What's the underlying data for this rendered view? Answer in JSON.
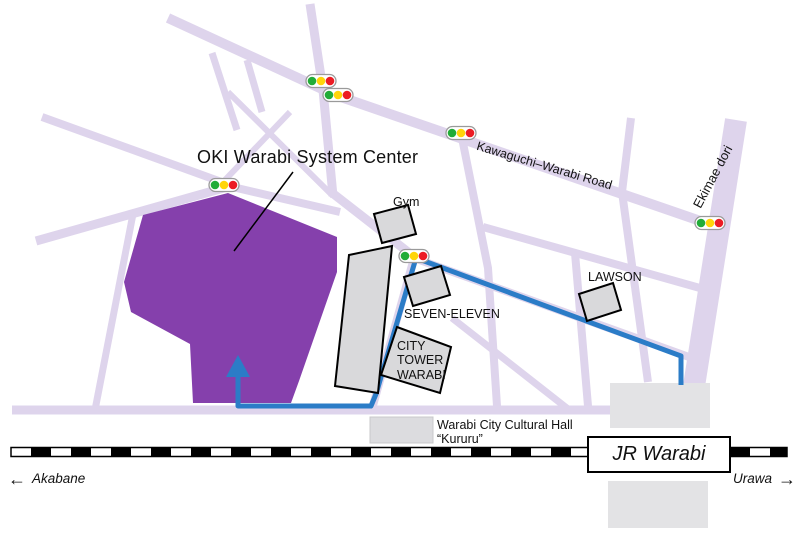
{
  "map": {
    "title": "OKI Warabi System Center",
    "roads": {
      "kawaguchi_label": "Kawaguchi–Warabi Road",
      "ekimae_label": "Ekimae dori"
    },
    "places": {
      "gym": "Gym",
      "seven_eleven": "SEVEN-ELEVEN",
      "lawson": "LAWSON",
      "city_tower_line1": "CITY",
      "city_tower_line2": "TOWER",
      "city_tower_line3": "WARABI",
      "cultural_hall_line1": "Warabi City Cultural Hall",
      "cultural_hall_line2": "“Kururu”",
      "station": "JR Warabi"
    },
    "directions": {
      "left_arrow": "←",
      "left": "Akabane",
      "right": "Urawa",
      "right_arrow": "→"
    },
    "colors": {
      "road": "#ded4ec",
      "oki_building": "#8540ac",
      "route_blue": "#2b7cc7",
      "building_gray": "#d9d9db",
      "platform_gray": "#e3e3e5",
      "signal_green": "#21ac38",
      "signal_yellow": "#ffd50a",
      "signal_red": "#ec1c24"
    },
    "traffic_lights": [
      {
        "x": 321,
        "y": 81
      },
      {
        "x": 338,
        "y": 95
      },
      {
        "x": 461,
        "y": 133
      },
      {
        "x": 224,
        "y": 185
      },
      {
        "x": 414,
        "y": 256
      },
      {
        "x": 710,
        "y": 223
      }
    ]
  }
}
